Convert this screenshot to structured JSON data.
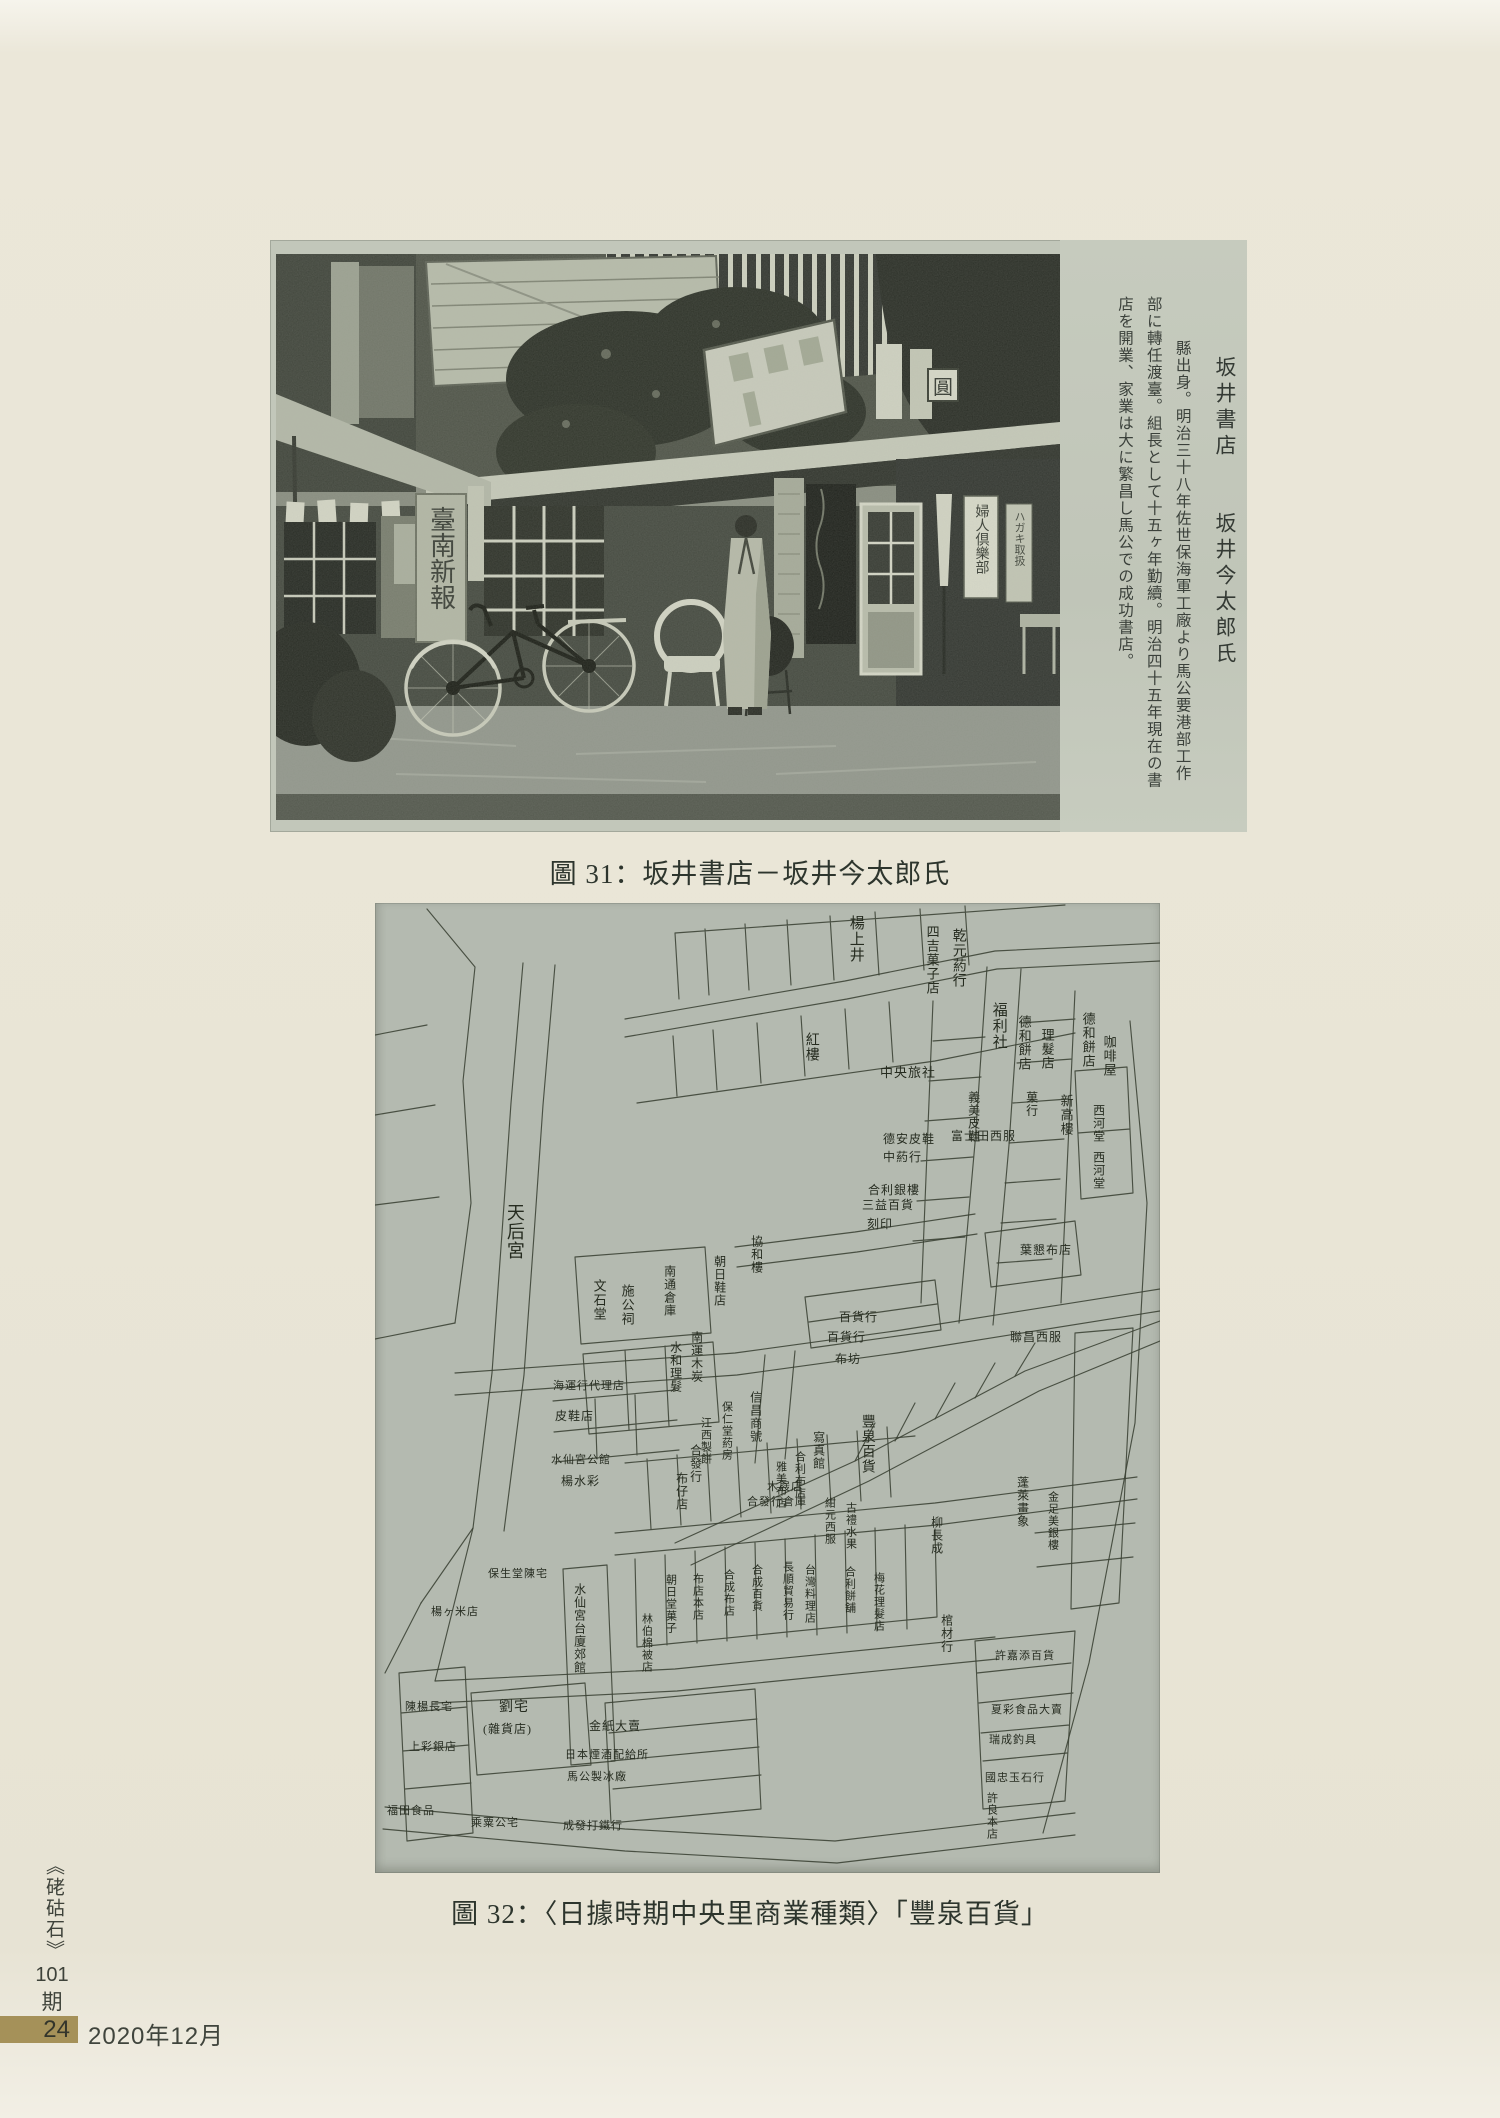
{
  "figure31": {
    "caption": "圖 31：坂井書店－坂井今太郎氏",
    "photo_signs": {
      "newspaper_banner": "臺南新報",
      "magazine_banner": "婦人倶樂部",
      "postcard_banner": "ハガキ取扱",
      "round_sign": "圓"
    },
    "side_text": {
      "col1": "坂井書店　　坂井今太郎氏",
      "col2": "縣出身。明治三十八年佐世保海軍工廠より馬公要港部工作",
      "col3": "部に轉任渡臺。組長として十五ヶ年勤續。明治四十五年現在の書",
      "col4": "店を開業、家業は大に繁昌し馬公での成功書店。"
    }
  },
  "figure32": {
    "caption": "圖 32：〈日據時期中央里商業種類〉「豐泉百貨」",
    "map": {
      "ink": "#3a4133",
      "bg": "#b4bab0",
      "labels": [
        {
          "t": "天后宮",
          "d": "v",
          "x": 130,
          "y": 300,
          "s": 18
        },
        {
          "t": "楊上井",
          "d": "v",
          "x": 472,
          "y": 12,
          "s": 15
        },
        {
          "t": "乾元葯行",
          "d": "v",
          "x": 575,
          "y": 25,
          "s": 14
        },
        {
          "t": "四吉菓子店",
          "d": "v",
          "x": 550,
          "y": 22,
          "s": 13
        },
        {
          "t": "福利社",
          "d": "v",
          "x": 615,
          "y": 99,
          "s": 15
        },
        {
          "t": "德和餅店",
          "d": "v",
          "x": 642,
          "y": 112,
          "s": 13
        },
        {
          "t": "理髮店",
          "d": "v",
          "x": 665,
          "y": 125,
          "s": 13
        },
        {
          "t": "德和餅店",
          "d": "v",
          "x": 706,
          "y": 109,
          "s": 13
        },
        {
          "t": "咖啡屋",
          "d": "v",
          "x": 727,
          "y": 132,
          "s": 13
        },
        {
          "t": "紅樓",
          "d": "v",
          "x": 428,
          "y": 129,
          "s": 14
        },
        {
          "t": "中央旅社",
          "d": "h",
          "x": 505,
          "y": 163,
          "s": 13
        },
        {
          "t": "義美皮鞋",
          "d": "v",
          "x": 592,
          "y": 188,
          "s": 12
        },
        {
          "t": "菓行",
          "d": "v",
          "x": 650,
          "y": 188,
          "s": 12
        },
        {
          "t": "新高樓",
          "d": "v",
          "x": 684,
          "y": 191,
          "s": 13
        },
        {
          "t": "西河堂",
          "d": "v",
          "x": 717,
          "y": 201,
          "s": 12
        },
        {
          "t": "西河堂",
          "d": "v",
          "x": 717,
          "y": 248,
          "s": 12
        },
        {
          "t": "富士田西服",
          "d": "h",
          "x": 576,
          "y": 227,
          "s": 12
        },
        {
          "t": "德安皮鞋",
          "d": "h",
          "x": 508,
          "y": 230,
          "s": 12
        },
        {
          "t": "中葯行",
          "d": "h",
          "x": 508,
          "y": 248,
          "s": 12
        },
        {
          "t": "合利銀樓",
          "d": "h",
          "x": 493,
          "y": 281,
          "s": 12
        },
        {
          "t": "三益百貨",
          "d": "h",
          "x": 487,
          "y": 296,
          "s": 12
        },
        {
          "t": "刻印",
          "d": "h",
          "x": 492,
          "y": 315,
          "s": 12
        },
        {
          "t": "葉懇布店",
          "d": "h",
          "x": 645,
          "y": 341,
          "s": 12
        },
        {
          "t": "文石堂",
          "d": "v",
          "x": 217,
          "y": 376,
          "s": 13
        },
        {
          "t": "施公祠",
          "d": "v",
          "x": 245,
          "y": 381,
          "s": 13
        },
        {
          "t": "協和樓",
          "d": "v",
          "x": 375,
          "y": 332,
          "s": 12
        },
        {
          "t": "朝日鞋店",
          "d": "v",
          "x": 338,
          "y": 352,
          "s": 12
        },
        {
          "t": "南通倉庫",
          "d": "v",
          "x": 288,
          "y": 362,
          "s": 12
        },
        {
          "t": "百貨行",
          "d": "h",
          "x": 464,
          "y": 408,
          "s": 12
        },
        {
          "t": "百貨行",
          "d": "h",
          "x": 452,
          "y": 428,
          "s": 12
        },
        {
          "t": "布坊",
          "d": "h",
          "x": 460,
          "y": 450,
          "s": 12
        },
        {
          "t": "南運木炭",
          "d": "v",
          "x": 315,
          "y": 428,
          "s": 12
        },
        {
          "t": "水和理髮",
          "d": "v",
          "x": 294,
          "y": 438,
          "s": 12
        },
        {
          "t": "聯昌西服",
          "d": "h",
          "x": 635,
          "y": 428,
          "s": 12
        },
        {
          "t": "海運行代理店",
          "d": "h",
          "x": 178,
          "y": 478,
          "s": 11
        },
        {
          "t": "皮鞋店",
          "d": "h",
          "x": 180,
          "y": 507,
          "s": 12
        },
        {
          "t": "豐泉百貨",
          "d": "v",
          "x": 484,
          "y": 511,
          "s": 14
        },
        {
          "t": "信昌商號",
          "d": "v",
          "x": 374,
          "y": 488,
          "s": 12
        },
        {
          "t": "保仁堂葯房",
          "d": "v",
          "x": 345,
          "y": 498,
          "s": 11
        },
        {
          "t": "江西製餅",
          "d": "v",
          "x": 324,
          "y": 514,
          "s": 11
        },
        {
          "t": "寫真館",
          "d": "v",
          "x": 437,
          "y": 528,
          "s": 12
        },
        {
          "t": "合利布店",
          "d": "v",
          "x": 418,
          "y": 548,
          "s": 11
        },
        {
          "t": "雅美布店",
          "d": "v",
          "x": 399,
          "y": 558,
          "s": 11
        },
        {
          "t": "木屐店",
          "d": "h",
          "x": 392,
          "y": 579,
          "s": 11
        },
        {
          "t": "合發行倉庫",
          "d": "h",
          "x": 372,
          "y": 594,
          "s": 11
        },
        {
          "t": "合發行",
          "d": "v",
          "x": 314,
          "y": 541,
          "s": 12
        },
        {
          "t": "布仔店",
          "d": "v",
          "x": 300,
          "y": 569,
          "s": 12
        },
        {
          "t": "水仙宮公館",
          "d": "h",
          "x": 176,
          "y": 552,
          "s": 11
        },
        {
          "t": "楊水彩",
          "d": "h",
          "x": 186,
          "y": 572,
          "s": 12
        },
        {
          "t": "紺元西服",
          "d": "v",
          "x": 448,
          "y": 594,
          "s": 11
        },
        {
          "t": "古禮水果",
          "d": "v",
          "x": 469,
          "y": 599,
          "s": 11
        },
        {
          "t": "蓬萊畫象",
          "d": "v",
          "x": 641,
          "y": 573,
          "s": 12
        },
        {
          "t": "金足美銀樓",
          "d": "v",
          "x": 671,
          "y": 588,
          "s": 11
        },
        {
          "t": "柳長成",
          "d": "v",
          "x": 555,
          "y": 613,
          "s": 12
        },
        {
          "t": "棺材行",
          "d": "v",
          "x": 565,
          "y": 711,
          "s": 12
        },
        {
          "t": "保生堂陳宅",
          "d": "h",
          "x": 113,
          "y": 666,
          "s": 11
        },
        {
          "t": "楊ヶ米店",
          "d": "h",
          "x": 56,
          "y": 704,
          "s": 11
        },
        {
          "t": "水仙宮台廈郊館",
          "d": "v",
          "x": 198,
          "y": 680,
          "s": 12
        },
        {
          "t": "林伯棉被店",
          "d": "v",
          "x": 265,
          "y": 710,
          "s": 11
        },
        {
          "t": "朝日堂菓子",
          "d": "v",
          "x": 289,
          "y": 671,
          "s": 11
        },
        {
          "t": "布店本店",
          "d": "v",
          "x": 316,
          "y": 670,
          "s": 11
        },
        {
          "t": "合成布店",
          "d": "v",
          "x": 347,
          "y": 666,
          "s": 11
        },
        {
          "t": "合成百貨",
          "d": "v",
          "x": 375,
          "y": 661,
          "s": 11
        },
        {
          "t": "長順貿易行",
          "d": "v",
          "x": 406,
          "y": 658,
          "s": 11
        },
        {
          "t": "台灣料理店",
          "d": "v",
          "x": 428,
          "y": 661,
          "s": 11
        },
        {
          "t": "合利餅舖",
          "d": "v",
          "x": 468,
          "y": 663,
          "s": 11
        },
        {
          "t": "梅花理髮店",
          "d": "v",
          "x": 497,
          "y": 669,
          "s": 11
        },
        {
          "t": "陳楊長宅",
          "d": "h",
          "x": 30,
          "y": 799,
          "s": 11
        },
        {
          "t": "上彩銀店",
          "d": "h",
          "x": 34,
          "y": 839,
          "s": 11
        },
        {
          "t": "福田食品",
          "d": "h",
          "x": 12,
          "y": 903,
          "s": 11
        },
        {
          "t": "劉宅",
          "d": "h",
          "x": 124,
          "y": 798,
          "s": 14
        },
        {
          "t": "(雜貨店)",
          "d": "h",
          "x": 108,
          "y": 820,
          "s": 12
        },
        {
          "t": "金紙大賣",
          "d": "h",
          "x": 214,
          "y": 817,
          "s": 12
        },
        {
          "t": "日本煙酒配給所",
          "d": "h",
          "x": 190,
          "y": 847,
          "s": 11
        },
        {
          "t": "馬公製冰廠",
          "d": "h",
          "x": 192,
          "y": 869,
          "s": 11
        },
        {
          "t": "成發打鐵行",
          "d": "h",
          "x": 188,
          "y": 918,
          "s": 11
        },
        {
          "t": "乘粟公宅",
          "d": "h",
          "x": 96,
          "y": 915,
          "s": 11
        },
        {
          "t": "許嘉添百貨",
          "d": "h",
          "x": 620,
          "y": 748,
          "s": 11
        },
        {
          "t": "夏彩食品大賣",
          "d": "h",
          "x": 616,
          "y": 802,
          "s": 11
        },
        {
          "t": "瑞成釣具",
          "d": "h",
          "x": 614,
          "y": 832,
          "s": 11
        },
        {
          "t": "國忠玉石行",
          "d": "h",
          "x": 610,
          "y": 870,
          "s": 11
        },
        {
          "t": "許良本店",
          "d": "v",
          "x": 610,
          "y": 889,
          "s": 11
        }
      ],
      "paths": [
        "M52,6 L100,64 L88,178 L96,300 L80,420",
        "M148,60 L136,200 L127,330 L117,470 L98,625 L46,700",
        "M180,62 L168,202 L159,332 L149,472 L129,628",
        "M0,132 L52,122 M0,212 L60,202 M0,302 L64,294 M80,420 L0,436",
        "M250,116 L470,78 L620,48 L785,40",
        "M250,134 L472,96 L622,66 L785,58",
        "M300,30 L690,2 M300,30 L304,96 M330,26 L334,92 M370,21 L374,87 M412,17 L416,82 M455,13 L459,77 M500,9 L504,72 M545,6 L549,67 M590,3 L594,62",
        "M262,200 L560,158 L700,130 M302,193 L298,133 M342,187 L338,127 M386,180 L382,120 M430,173 L426,113 M474,166 L470,106 M518,159 L514,99",
        "M612,64 L600,240 L584,420",
        "M646,66 L634,242 L618,422",
        "M700,88 L686,400 M646,120 L700,116 M642,160 L697,156 M638,200 L693,196 M634,240 L689,236 M630,280 L685,276 M626,320 L681,316 M622,360 L677,356",
        "M558,98 L546,400 M558,138 L610,134 M554,178 L606,174 M550,218 L602,214 M546,258 L598,254 M542,298 L594,294 M538,338 L590,334",
        "M755,118 L772,300 L760,520 L714,760 L668,930",
        "M700,168 L752,164 L758,290 L706,296 Z M703,230 L755,226",
        "M80,470 L360,450 L520,428 L785,386",
        "M80,492 L362,472 L522,450 L785,408",
        "M430,394 L560,377 L566,427 L436,445 Z M434,419 L562,401",
        "M300,640 L480,558 L650,468 L785,418",
        "M316,662 L494,578 L664,488 L785,438",
        "M480,558 L500,520 M520,538 L540,500 M560,516 L580,480 M600,495 L620,460 M640,473 L660,440",
        "M200,354 L330,344 L336,430 L206,441 Z",
        "M208,451 L338,439 L344,519 L214,531 Z M250,447 L254,527 M290,443 L294,523",
        "M178,498 L300,487 M179,529 L302,517 M180,559 L304,547 M220,496 L222,556 M260,492 L262,552",
        "M360,344 L480,329 L600,311 M362,364 L482,349 L602,331",
        "M610,330 L700,318 L706,372 L616,384 Z",
        "M250,560 L540,533 M272,556 L276,626 M302,552 L306,622 M332,548 L336,618 M362,544 L366,614 M392,540 L396,610 M422,536 L426,606 M452,532 L456,602 M482,528 L486,598 M512,524 L516,594",
        "M240,630 L560,600 L762,574",
        "M240,652 L562,622 L762,596",
        "M260,656 L262,744 L562,714 L560,626 M290,652 L292,742 M320,648 L322,740 M350,644 L352,738 M380,640 L382,736 M410,636 L412,734 M440,632 L442,732 M470,628 L472,730 M500,625 L502,728 M530,622 L532,726",
        "M60,778 L300,766 L620,734",
        "M60,800 L302,788 L622,756",
        "M96,790 L210,780 L216,862 L102,872 Z",
        "M230,800 L380,786 L386,906 L236,920 Z M234,830 L382,816 M236,858 L384,844 M238,886 L386,872",
        "M24,770 L90,764 L98,930 L32,938 Z M26,810 L92,804 M28,848 L94,842 M30,886 L96,880",
        "M188,666 L232,662 L240,858 L196,862 Z",
        "M10,904 L250,926 L460,938 L700,910 M8,926 L250,948 L462,960 L700,932",
        "M600,738 L700,728 L690,898 L608,906 Z M602,770 L696,760 M604,800 L698,790 M606,830 L694,822 M608,858 L692,850",
        "M700,430 L758,425 L744,700 L696,706 Z",
        "M390,452 L380,560 M420,448 L410,556",
        "M98,625 L60,778 M46,700 L10,770",
        "M660,630 L760,620 M662,664 L758,654"
      ]
    }
  },
  "footer": {
    "journal_title": "《硓𥑮石》",
    "issue": "101",
    "issue_suffix": "期",
    "page_number": "24",
    "date": "2020年12月",
    "band_color": "#a59159"
  }
}
